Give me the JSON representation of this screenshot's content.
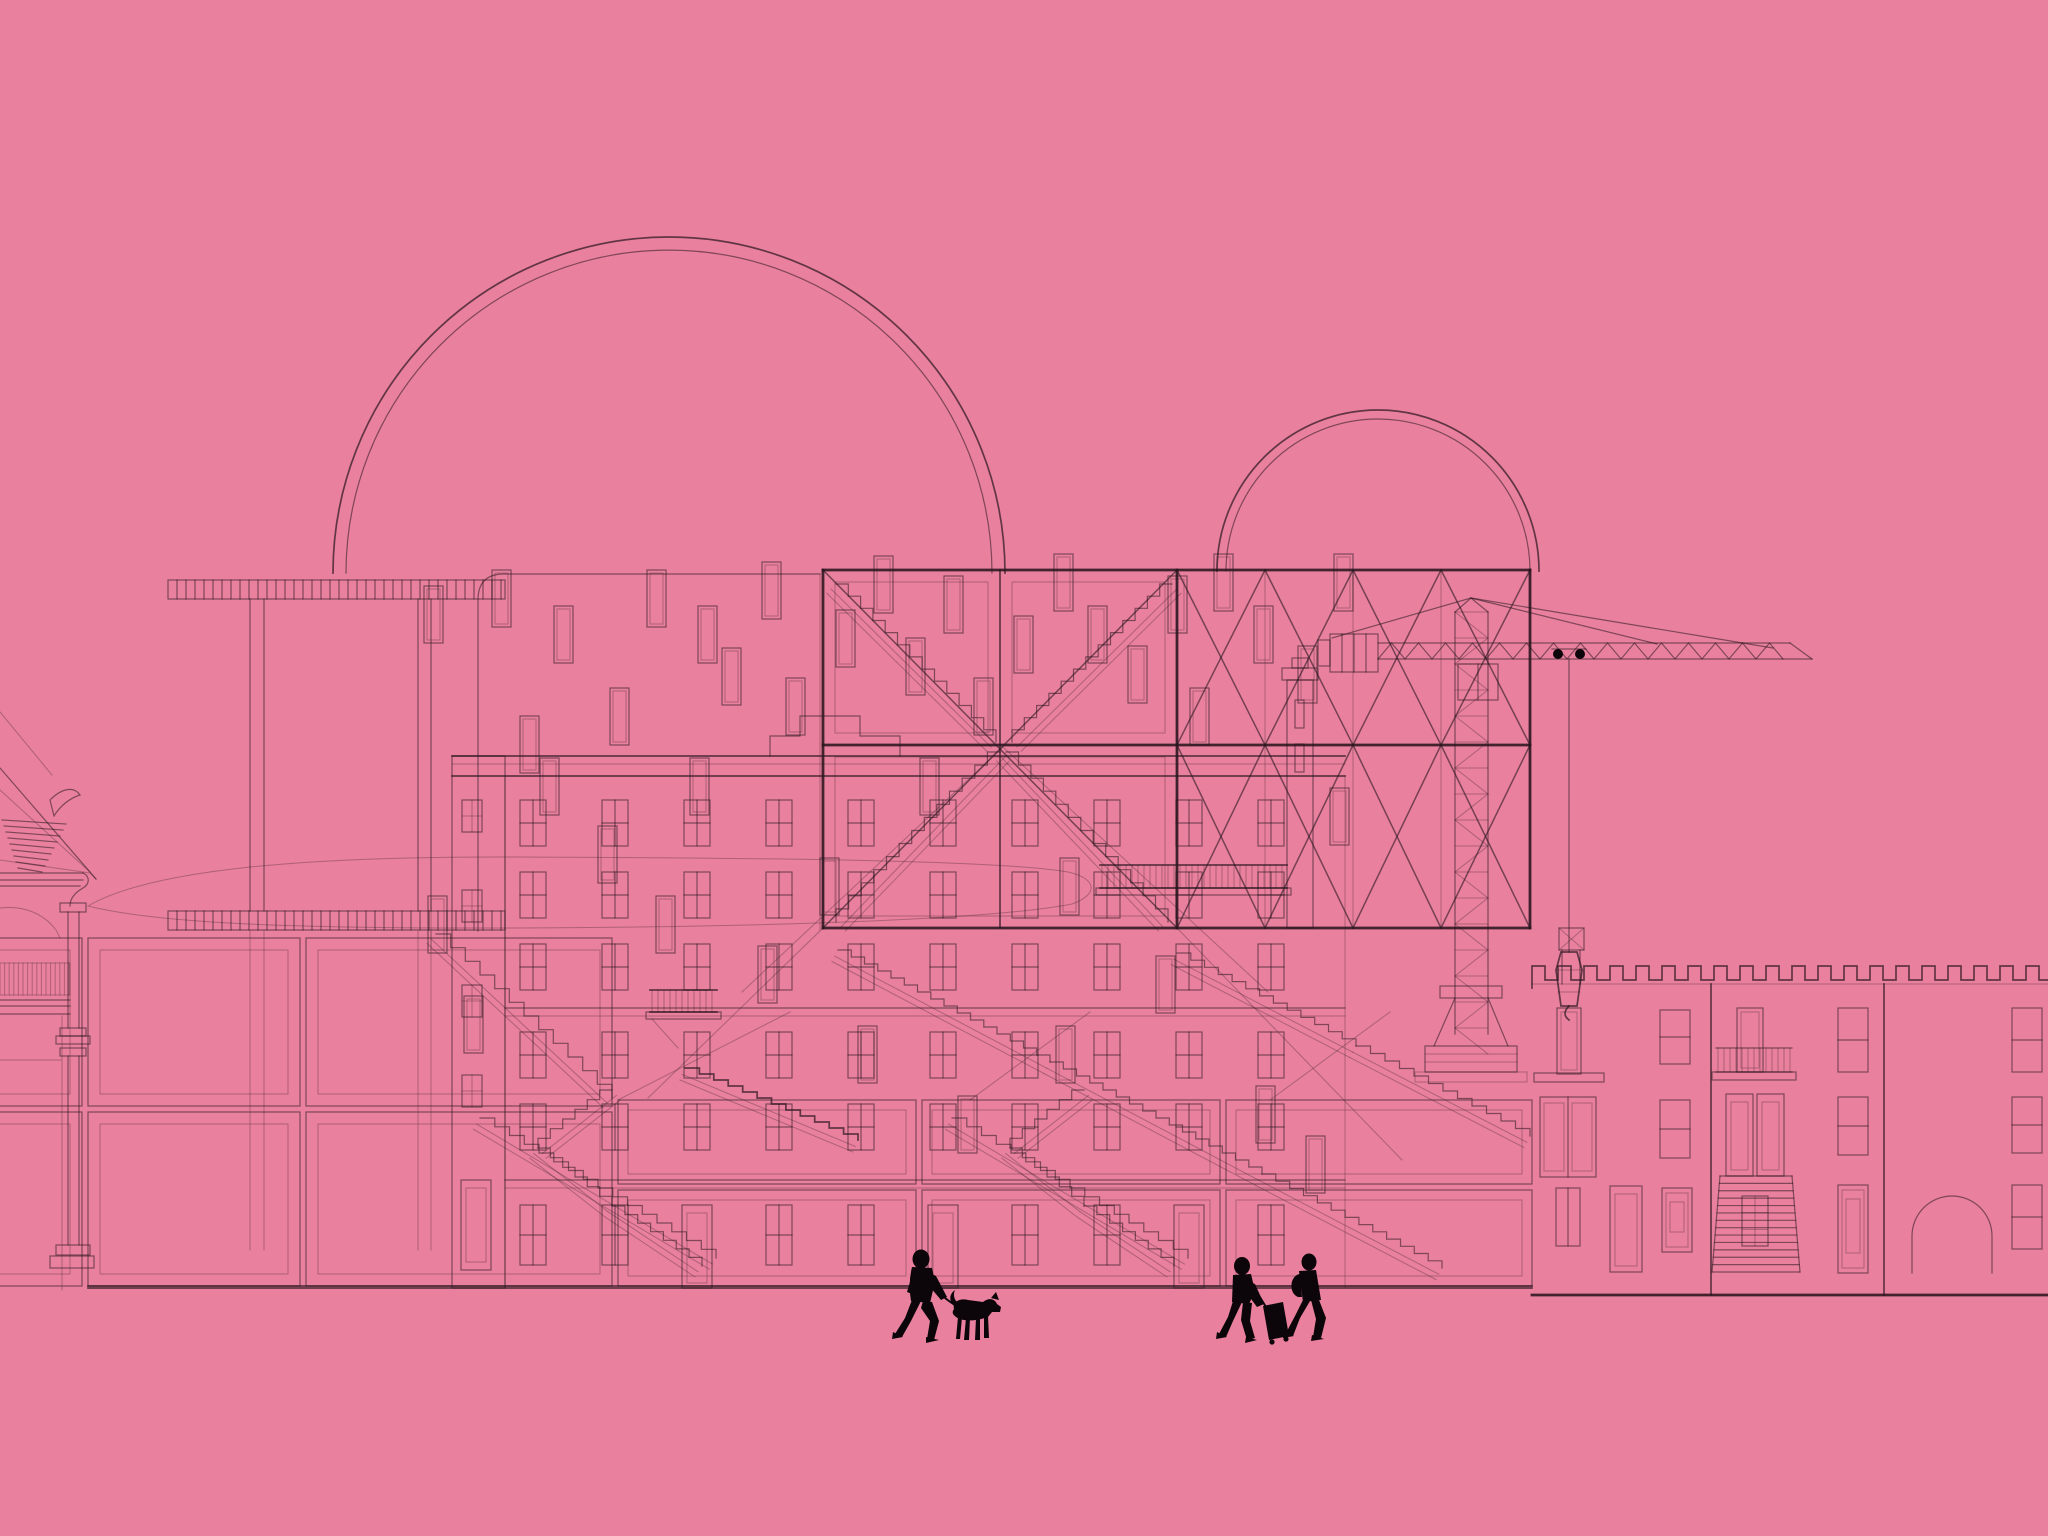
{
  "alt": "Architectural collage line drawing on a pink background: domes, stair frames, apartment facade, tower crane, crenellated rowhouses, basement grids and pedestrian silhouettes",
  "colors": {
    "background": "#e8809e",
    "line": "#2a161f",
    "figure": "#0c0509"
  },
  "scene": {
    "domes": [
      {
        "cx": 669,
        "baseY": 573,
        "rOuter": 336,
        "rInner": 323
      },
      {
        "cx": 1378,
        "baseY": 571,
        "rOuter": 161,
        "rInner": 152
      }
    ],
    "hatches": [
      {
        "x": 168,
        "y": 580,
        "w": 337,
        "h": 19,
        "pitch": 9,
        "cls": "ln"
      },
      {
        "x": 168,
        "y": 911,
        "w": 337,
        "h": 19,
        "pitch": 9,
        "cls": "ln"
      },
      {
        "x": 0,
        "y": 963,
        "w": 70,
        "h": 32,
        "pitch": 4.6,
        "cls": "ln-soft"
      }
    ],
    "posts": {
      "pairs": [
        [
          250,
          264
        ],
        [
          418,
          431
        ]
      ],
      "seg1": [
        599,
        911
      ],
      "seg2": [
        931,
        1250
      ]
    },
    "floating_windows": {
      "w": 19,
      "h": 57,
      "pos": [
        [
          492,
          570
        ],
        [
          554,
          606
        ],
        [
          610,
          688
        ],
        [
          647,
          570
        ],
        [
          698,
          606
        ],
        [
          722,
          648
        ],
        [
          762,
          562
        ],
        [
          786,
          678
        ],
        [
          540,
          758
        ],
        [
          598,
          826
        ],
        [
          520,
          716
        ],
        [
          656,
          896
        ],
        [
          424,
          586
        ],
        [
          428,
          896
        ],
        [
          464,
          996
        ],
        [
          836,
          610
        ],
        [
          874,
          556
        ],
        [
          906,
          638
        ],
        [
          944,
          576
        ],
        [
          974,
          678
        ],
        [
          1014,
          616
        ],
        [
          1054,
          554
        ],
        [
          1088,
          606
        ],
        [
          1128,
          646
        ],
        [
          1168,
          576
        ],
        [
          1214,
          554
        ],
        [
          1254,
          606
        ],
        [
          1298,
          646
        ],
        [
          1334,
          554
        ],
        [
          858,
          1026
        ],
        [
          958,
          1096
        ],
        [
          1056,
          1026
        ],
        [
          1156,
          956
        ],
        [
          1256,
          1086
        ],
        [
          1306,
          1136
        ],
        [
          758,
          946
        ],
        [
          690,
          758
        ],
        [
          820,
          858
        ],
        [
          920,
          758
        ],
        [
          1060,
          858
        ],
        [
          1190,
          688
        ],
        [
          1330,
          788
        ]
      ]
    },
    "building": {
      "wing": {
        "x": 452,
        "w": 53,
        "top": 756,
        "bottom": 1288,
        "win_rows": [
          800,
          890,
          985,
          1075
        ],
        "door": [
          461,
          1180,
          30,
          90
        ]
      },
      "cornice": {
        "x0": 452,
        "x1": 1345,
        "lines": [
          756,
          776
        ],
        "soft": 764
      },
      "parapet_path": "M770,756 V736 H800 V716 H860 V736 H900 V756",
      "edges": [
        505,
        1345
      ],
      "top": 776,
      "bottom": 1288,
      "bands": [
        [
          1008,
          1016
        ],
        [
          1180,
          1188
        ]
      ],
      "cols": [
        520,
        602,
        684,
        766,
        848,
        930,
        1012,
        1094,
        1176,
        1258
      ],
      "rows": [
        800,
        872,
        944,
        1032,
        1104
      ],
      "win": {
        "w": 26,
        "h": 46
      },
      "ground": {
        "y": 1205,
        "h": 60,
        "door_cols": [
          2,
          5,
          8
        ]
      }
    },
    "balconies": [
      {
        "x": 1100,
        "w": 187,
        "railTop": 865,
        "railBot": 888,
        "pitch": 6,
        "brace": false
      },
      {
        "x": 650,
        "w": 67,
        "railTop": 990,
        "railBot": 1012,
        "pitch": 6,
        "brace": true
      }
    ],
    "frames": {
      "bold_lines": [
        [
          823,
          570,
          1530,
          570
        ],
        [
          823,
          745,
          1530,
          745
        ],
        [
          823,
          928,
          1530,
          928
        ],
        [
          823,
          570,
          823,
          928
        ],
        [
          1177,
          570,
          1177,
          928
        ],
        [
          1530,
          570,
          1530,
          928
        ]
      ],
      "med_lines": [
        [
          1000,
          570,
          1000,
          928
        ]
      ],
      "inner_rects": [
        [
          835,
          582,
          153,
          151
        ],
        [
          1012,
          582,
          153,
          151
        ],
        [
          835,
          757,
          330,
          159
        ]
      ],
      "x_lines": [
        [
          823,
          570,
          1177,
          928
        ],
        [
          1177,
          570,
          823,
          928
        ]
      ],
      "stairs": [
        {
          "x0": 836,
          "y0": 584,
          "x1": 996,
          "y1": 742,
          "n": 13
        },
        {
          "x0": 1172,
          "y0": 584,
          "x1": 1012,
          "y1": 742,
          "n": 13
        },
        {
          "x0": 1006,
          "y0": 752,
          "x1": 1168,
          "y1": 922,
          "n": 13
        },
        {
          "x0": 1000,
          "y0": 752,
          "x1": 836,
          "y1": 922,
          "n": 13
        }
      ]
    },
    "truss": {
      "cols": [
        1177,
        1265,
        1353,
        1441,
        1530
      ],
      "rows": [
        570,
        745,
        928
      ]
    },
    "crane": {
      "mast": {
        "x0": 1455,
        "x1": 1488,
        "y0": 612,
        "y1": 1034,
        "pitch": 26
      },
      "jib": {
        "x0": 1378,
        "x1": 1790,
        "top": 643,
        "bot": 659,
        "pitch": 27
      },
      "apex": [
        1471,
        598
      ],
      "ties": [
        [
          1332,
          638
        ],
        [
          1657,
          644
        ],
        [
          1773,
          648
        ]
      ],
      "cable_x": 1569,
      "cable_y1": 659,
      "cable_y2": 952
    },
    "rowhouse": {
      "span": [
        1532,
        2048
      ],
      "merlon": {
        "top": 966,
        "base": 980,
        "tooth": 13
      },
      "baseline": 984,
      "ground": 1295,
      "walls": [
        1711,
        1884
      ],
      "windows": [
        {
          "type": "sill",
          "x": 1534,
          "y": 1073,
          "w": 70,
          "h": 9
        },
        {
          "type": "tall",
          "x": 1557,
          "y": 1008,
          "w": 24,
          "h": 66
        },
        {
          "type": "stack2",
          "x": 1660,
          "y": 1010,
          "w": 30,
          "h": 54
        },
        {
          "type": "casement",
          "x": 1540,
          "y": 1097,
          "w": 56,
          "h": 80
        },
        {
          "type": "stack2",
          "x": 1660,
          "y": 1100,
          "w": 30,
          "h": 58
        },
        {
          "type": "pair",
          "x": 1556,
          "y": 1188,
          "w": 24,
          "h": 58
        },
        {
          "type": "door",
          "x": 1610,
          "y": 1186,
          "w": 32,
          "h": 86
        },
        {
          "type": "shutter",
          "x": 1662,
          "y": 1188,
          "w": 30,
          "h": 64
        },
        {
          "type": "tall",
          "x": 1737,
          "y": 1008,
          "w": 26,
          "h": 64
        },
        {
          "type": "balcony",
          "x": 1716,
          "y": 1048,
          "w": 76,
          "h": 34
        },
        {
          "type": "door",
          "x": 1726,
          "y": 1094,
          "w": 27,
          "h": 82
        },
        {
          "type": "door",
          "x": 1757,
          "y": 1094,
          "w": 27,
          "h": 82
        },
        {
          "type": "stoop",
          "x": 1720,
          "y": 1176,
          "w": 72,
          "h": 96
        },
        {
          "type": "gridmat",
          "x": 1742,
          "y": 1196,
          "w": 26,
          "h": 50
        },
        {
          "type": "stack2",
          "x": 1838,
          "y": 1008,
          "w": 30,
          "h": 64
        },
        {
          "type": "stack2",
          "x": 1838,
          "y": 1097,
          "w": 30,
          "h": 58
        },
        {
          "type": "shutter",
          "x": 1838,
          "y": 1185,
          "w": 30,
          "h": 88
        },
        {
          "type": "arch",
          "x": 1912,
          "y": 1186,
          "w": 80,
          "h": 87
        },
        {
          "type": "stack2",
          "x": 2012,
          "y": 1008,
          "w": 30,
          "h": 64
        },
        {
          "type": "stack2",
          "x": 2012,
          "y": 1097,
          "w": 30,
          "h": 56
        },
        {
          "type": "stack2",
          "x": 2012,
          "y": 1185,
          "w": 30,
          "h": 64
        },
        {
          "type": "flag",
          "x": 1559,
          "y": 928,
          "w": 25,
          "h": 22
        }
      ]
    },
    "basements": {
      "left": {
        "cols": [
          [
            88,
            300
          ],
          [
            306,
            612
          ]
        ],
        "rows": [
          [
            938,
            1106
          ],
          [
            1112,
            1286
          ]
        ],
        "sliver": [
          -30,
          82
        ],
        "inset": 12
      },
      "center": {
        "cols": [
          [
            618,
            916
          ],
          [
            922,
            1220
          ],
          [
            1226,
            1532
          ]
        ],
        "rows": [
          [
            1100,
            1184
          ],
          [
            1190,
            1286
          ]
        ],
        "inset": 10
      },
      "ground_line": [
        88,
        1286,
        1532,
        1286
      ]
    },
    "stairs": [
      {
        "x0": 436,
        "y0": 934,
        "x1": 612,
        "y1": 1098,
        "n": 12
      },
      {
        "x0": 612,
        "y0": 1090,
        "x1": 538,
        "y1": 1148,
        "n": 6
      },
      {
        "x0": 538,
        "y0": 1148,
        "x1": 612,
        "y1": 1206,
        "n": 6
      },
      {
        "x0": 612,
        "y0": 1206,
        "x1": 702,
        "y1": 1266,
        "n": 7
      },
      {
        "x0": 480,
        "y0": 1118,
        "x1": 716,
        "y1": 1258,
        "n": 16
      },
      {
        "x0": 1084,
        "y0": 1090,
        "x1": 1010,
        "y1": 1148,
        "n": 6
      },
      {
        "x0": 1010,
        "y0": 1148,
        "x1": 1084,
        "y1": 1206,
        "n": 6
      },
      {
        "x0": 1084,
        "y0": 1206,
        "x1": 1174,
        "y1": 1266,
        "n": 7
      },
      {
        "x0": 952,
        "y0": 1118,
        "x1": 1188,
        "y1": 1258,
        "n": 16
      },
      {
        "x0": 838,
        "y0": 950,
        "x1": 1050,
        "y1": 1062,
        "n": 16
      },
      {
        "x0": 1050,
        "y0": 1062,
        "x1": 1262,
        "y1": 1174,
        "n": 16
      },
      {
        "x0": 1262,
        "y0": 1174,
        "x1": 1442,
        "y1": 1268,
        "n": 13
      },
      {
        "x0": 1177,
        "y0": 953,
        "x1": 1356,
        "y1": 1046,
        "n": 13
      },
      {
        "x0": 1356,
        "y0": 1046,
        "x1": 1530,
        "y1": 1136,
        "n": 12
      },
      {
        "x0": 685,
        "y0": 1068,
        "x1": 858,
        "y1": 1140,
        "n": 12,
        "bold": true
      }
    ],
    "xlines": [
      [
        823,
        928,
        648,
        1098
      ],
      [
        1177,
        928,
        1402,
        1160
      ],
      [
        1003,
        747,
        1268,
        992
      ],
      [
        1003,
        747,
        742,
        992
      ],
      [
        618,
        1100,
        790,
        1012
      ],
      [
        970,
        1100,
        1090,
        1012
      ],
      [
        1270,
        1100,
        1390,
        1012
      ]
    ]
  },
  "silhouettes": [
    "person-walking-dog",
    "traveler-with-rolling-suitcase",
    "traveler-with-backpack"
  ]
}
